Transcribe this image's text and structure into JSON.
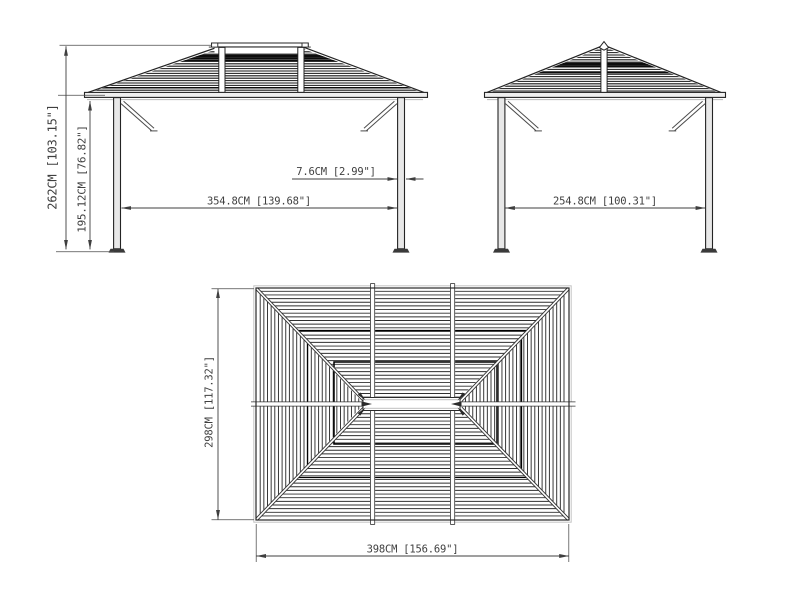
{
  "views": {
    "front": {
      "dims": {
        "overall_height": "262CM [103.15\"]",
        "post_height": "195.12CM [76.82\"]",
        "span": "354.8CM [139.68\"]",
        "post_width": "7.6CM [2.99\"]"
      }
    },
    "side": {
      "dims": {
        "span": "254.8CM [100.31\"]"
      }
    },
    "top": {
      "dims": {
        "depth": "298CM [117.32\"]",
        "width": "398CM [156.69\"]"
      }
    }
  },
  "colors": {
    "ink": "#242424",
    "dimension": "#3f3f3f",
    "background": "#ffffff"
  }
}
